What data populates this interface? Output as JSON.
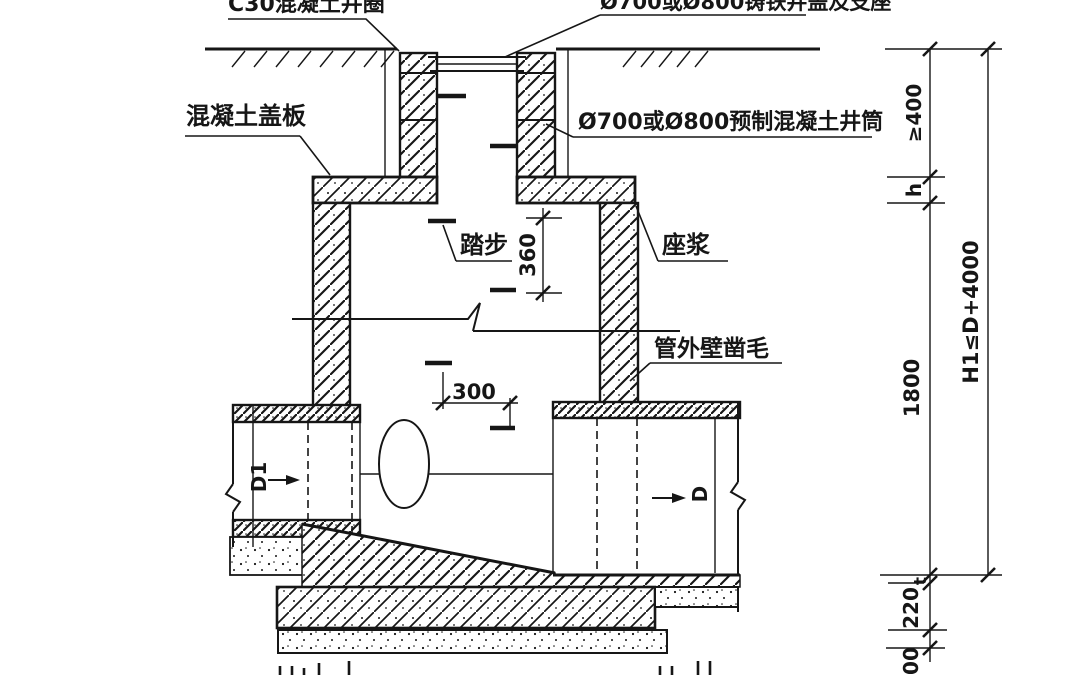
{
  "page": {
    "background": "#ffffff",
    "line_color": "#161616",
    "description": "Cross-section detail drawing of a precast concrete inspection manhole with inlet and outlet pipes"
  },
  "annotations": {
    "collar_label": "C30混凝土井圈",
    "cover_frame_label": "Ø700或Ø800铸铁井盖及支座",
    "shaft_label": "Ø700或Ø800预制混凝土井筒",
    "cover_slab_label": "混凝土盖板",
    "step_label": "踏步",
    "mortar_label": "座浆",
    "pipe_roughen_label": "管外壁凿毛"
  },
  "dimensions": {
    "min_cover_depth": "≥400",
    "slab_thickness": "h",
    "chamber_height": "1800",
    "seat_thickness": "t",
    "base_slab_thickness": "220",
    "cushion_thickness": "100",
    "overall_height": "H1≤D+4000",
    "step_spacing": "360",
    "bottom_step_offset": "300"
  },
  "pipe_labels": {
    "inlet": "D1",
    "outlet": "D"
  }
}
